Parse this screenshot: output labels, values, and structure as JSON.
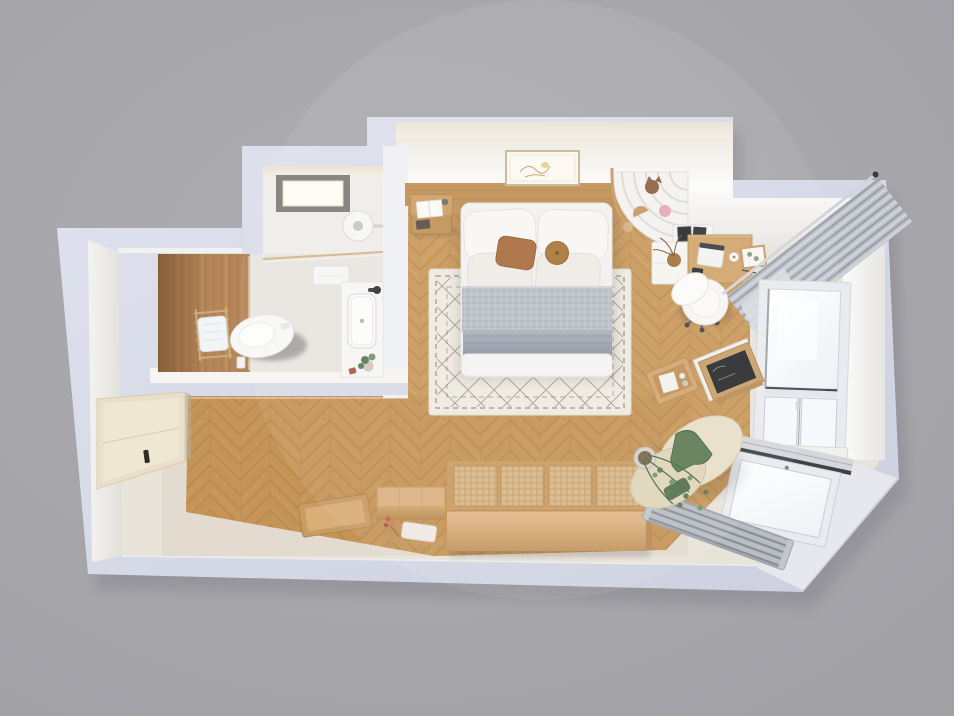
{
  "scene": {
    "description": "Top-down 3D rendered floor plan of a small studio apartment",
    "background": "#a8a8ad"
  },
  "palette": {
    "background": "#a8a8ad",
    "wall": "#e0e3ee",
    "wall_dark": "#ccd0df",
    "wall_face": "#f6f5f2",
    "ceiling": "#e9e1d3",
    "floor_light": "#e9e4da",
    "floor_wood": "#c9995c",
    "floor_wood_dark": "#b28049",
    "floor_wood_deep": "#a87a43",
    "wood_wall": "#b5875a",
    "wood_furniture": "#cb9d63",
    "wood_light": "#dcb183",
    "rattan": "#dab88a",
    "rug": "#f0ebe1",
    "rug_pattern": "#56504a",
    "linen": "#f4f2ef",
    "pillow": "#f8f7f4",
    "knit": "#bcc1c8",
    "blanket": "#9aa2ac",
    "cushion_brown": "#aa6e41",
    "cushion_round": "#ab783c",
    "curtain": "#bfc3ca",
    "curtain_dark": "#989da7",
    "sheer": "#dbdee3",
    "glass": "#f6fafd",
    "frame": "#e9ebee",
    "frame_dark": "#3e4145",
    "radiator": "#b9bec4",
    "radiator_dark": "#878e96",
    "green": "#5d7b54",
    "green_light": "#76976a",
    "green_blanket": "#5e7c55",
    "beige_cushion": "#e8dfc8",
    "closet": "#eadfc9",
    "brass": "#cfae7c",
    "chalk": "#2c2d2f",
    "white": "#f7f7f5",
    "toilet_shadow": "#3b3d43"
  },
  "rooms": {
    "bathroom": {
      "label": "Bathroom"
    },
    "bedroom": {
      "label": "Bedroom"
    },
    "workspace": {
      "label": "Desk nook"
    },
    "hallway": {
      "label": "Hallway and entry"
    },
    "corner": {
      "label": "Balcony window corner"
    }
  },
  "objects": {
    "toilet": {
      "label": "Toilet"
    },
    "shower_head": {
      "label": "Rain shower head"
    },
    "shower_light": {
      "label": "Recessed shower ceiling light"
    },
    "towel_ladder": {
      "label": "Ladder towel rack with towel"
    },
    "glass_partition": {
      "label": "Brass framed glass partition"
    },
    "vanity": {
      "label": "Vanity with sink"
    },
    "wood_accent_wall": {
      "label": "Wood accent wall"
    },
    "wall_art": {
      "label": "Framed botanical art"
    },
    "nightstand": {
      "label": "Nightstand with open book"
    },
    "bed": {
      "label": "Double bed with pillows and gray blankets"
    },
    "rug": {
      "label": "Cream rug with diamond pattern"
    },
    "clothes_rack": {
      "label": "Curved open clothes rack"
    },
    "desk": {
      "label": "Wooden desk with laptop"
    },
    "desk_cabinet": {
      "label": "White desk cabinet"
    },
    "desk_shelf": {
      "label": "Wall shelf with picture frames"
    },
    "chair": {
      "label": "White swivel chair"
    },
    "curtain": {
      "label": "Gray pleated curtain"
    },
    "sheer": {
      "label": "Sheer curtain"
    },
    "window_right": {
      "label": "Tall window"
    },
    "window_corner": {
      "label": "Corner window"
    },
    "radiator": {
      "label": "Floor radiator grille"
    },
    "floor_cushions": {
      "label": "Floor cushions with green blanket"
    },
    "plant": {
      "label": "Trailing potted plant"
    },
    "easel": {
      "label": "Chalkboard easel"
    },
    "toy_box": {
      "label": "Wooden toy box"
    },
    "daybed": {
      "label": "Rattan-top storage daybed"
    },
    "chest": {
      "label": "Low wooden chest"
    },
    "tray": {
      "label": "Leaning wooden tray"
    },
    "flowers": {
      "label": "Dried flowers and garland"
    },
    "closet": {
      "label": "Built-in closet"
    }
  }
}
